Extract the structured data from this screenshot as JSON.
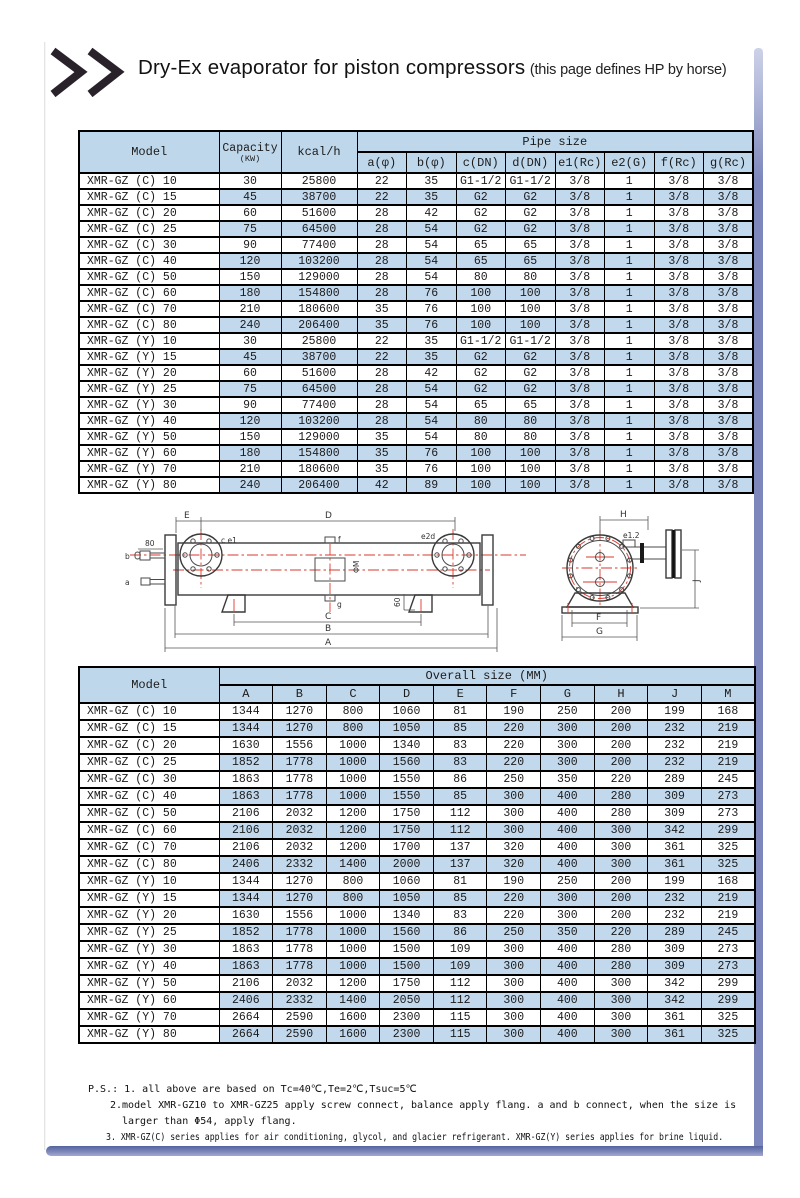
{
  "header": {
    "title": "Dry-Ex evaporator for piston compressors",
    "subtitle": "(this page defines HP by horse)",
    "chevron_icon": "double-chevron-right"
  },
  "colors": {
    "row_blue": "#c2d8ec",
    "header_blue": "#bfd7eb",
    "accent_bar": "#7d87bb",
    "drawing_red": "#d93a2e"
  },
  "pipe_table": {
    "col_model": "Model",
    "col_capacity": "Capacity",
    "col_capacity_unit": "(KW)",
    "col_kcal": "kcal/h",
    "group_header": "Pipe size",
    "sub_headers": [
      "a(φ)",
      "b(φ)",
      "c(DN)",
      "d(DN)",
      "e1(Rc)",
      "e2(G)",
      "f(Rc)",
      "g(Rc)"
    ],
    "rows": [
      [
        "XMR-GZ (C) 10",
        "30",
        "25800",
        "22",
        "35",
        "G1-1/2",
        "G1-1/2",
        "3/8",
        "1",
        "3/8",
        "3/8"
      ],
      [
        "XMR-GZ (C) 15",
        "45",
        "38700",
        "22",
        "35",
        "G2",
        "G2",
        "3/8",
        "1",
        "3/8",
        "3/8"
      ],
      [
        "XMR-GZ (C) 20",
        "60",
        "51600",
        "28",
        "42",
        "G2",
        "G2",
        "3/8",
        "1",
        "3/8",
        "3/8"
      ],
      [
        "XMR-GZ (C) 25",
        "75",
        "64500",
        "28",
        "54",
        "G2",
        "G2",
        "3/8",
        "1",
        "3/8",
        "3/8"
      ],
      [
        "XMR-GZ (C) 30",
        "90",
        "77400",
        "28",
        "54",
        "65",
        "65",
        "3/8",
        "1",
        "3/8",
        "3/8"
      ],
      [
        "XMR-GZ (C) 40",
        "120",
        "103200",
        "28",
        "54",
        "65",
        "65",
        "3/8",
        "1",
        "3/8",
        "3/8"
      ],
      [
        "XMR-GZ (C) 50",
        "150",
        "129000",
        "28",
        "54",
        "80",
        "80",
        "3/8",
        "1",
        "3/8",
        "3/8"
      ],
      [
        "XMR-GZ (C) 60",
        "180",
        "154800",
        "28",
        "76",
        "100",
        "100",
        "3/8",
        "1",
        "3/8",
        "3/8"
      ],
      [
        "XMR-GZ (C) 70",
        "210",
        "180600",
        "35",
        "76",
        "100",
        "100",
        "3/8",
        "1",
        "3/8",
        "3/8"
      ],
      [
        "XMR-GZ (C) 80",
        "240",
        "206400",
        "35",
        "76",
        "100",
        "100",
        "3/8",
        "1",
        "3/8",
        "3/8"
      ],
      [
        "XMR-GZ (Y) 10",
        "30",
        "25800",
        "22",
        "35",
        "G1-1/2",
        "G1-1/2",
        "3/8",
        "1",
        "3/8",
        "3/8"
      ],
      [
        "XMR-GZ (Y) 15",
        "45",
        "38700",
        "22",
        "35",
        "G2",
        "G2",
        "3/8",
        "1",
        "3/8",
        "3/8"
      ],
      [
        "XMR-GZ (Y) 20",
        "60",
        "51600",
        "28",
        "42",
        "G2",
        "G2",
        "3/8",
        "1",
        "3/8",
        "3/8"
      ],
      [
        "XMR-GZ (Y) 25",
        "75",
        "64500",
        "28",
        "54",
        "G2",
        "G2",
        "3/8",
        "1",
        "3/8",
        "3/8"
      ],
      [
        "XMR-GZ (Y) 30",
        "90",
        "77400",
        "28",
        "54",
        "65",
        "65",
        "3/8",
        "1",
        "3/8",
        "3/8"
      ],
      [
        "XMR-GZ (Y) 40",
        "120",
        "103200",
        "28",
        "54",
        "80",
        "80",
        "3/8",
        "1",
        "3/8",
        "3/8"
      ],
      [
        "XMR-GZ (Y) 50",
        "150",
        "129000",
        "35",
        "54",
        "80",
        "80",
        "3/8",
        "1",
        "3/8",
        "3/8"
      ],
      [
        "XMR-GZ (Y) 60",
        "180",
        "154800",
        "35",
        "76",
        "100",
        "100",
        "3/8",
        "1",
        "3/8",
        "3/8"
      ],
      [
        "XMR-GZ (Y) 70",
        "210",
        "180600",
        "35",
        "76",
        "100",
        "100",
        "3/8",
        "1",
        "3/8",
        "3/8"
      ],
      [
        "XMR-GZ (Y) 80",
        "240",
        "206400",
        "42",
        "89",
        "100",
        "100",
        "3/8",
        "1",
        "3/8",
        "3/8"
      ]
    ]
  },
  "size_table": {
    "col_model": "Model",
    "group_header": "Overall size (MM)",
    "sub_headers": [
      "A",
      "B",
      "C",
      "D",
      "E",
      "F",
      "G",
      "H",
      "J",
      "M"
    ],
    "rows": [
      [
        "XMR-GZ (C) 10",
        "1344",
        "1270",
        "800",
        "1060",
        "81",
        "190",
        "250",
        "200",
        "199",
        "168"
      ],
      [
        "XMR-GZ (C) 15",
        "1344",
        "1270",
        "800",
        "1050",
        "85",
        "220",
        "300",
        "200",
        "232",
        "219"
      ],
      [
        "XMR-GZ (C) 20",
        "1630",
        "1556",
        "1000",
        "1340",
        "83",
        "220",
        "300",
        "200",
        "232",
        "219"
      ],
      [
        "XMR-GZ (C) 25",
        "1852",
        "1778",
        "1000",
        "1560",
        "83",
        "220",
        "300",
        "200",
        "232",
        "219"
      ],
      [
        "XMR-GZ (C) 30",
        "1863",
        "1778",
        "1000",
        "1550",
        "86",
        "250",
        "350",
        "220",
        "289",
        "245"
      ],
      [
        "XMR-GZ (C) 40",
        "1863",
        "1778",
        "1000",
        "1550",
        "85",
        "300",
        "400",
        "280",
        "309",
        "273"
      ],
      [
        "XMR-GZ (C) 50",
        "2106",
        "2032",
        "1200",
        "1750",
        "112",
        "300",
        "400",
        "280",
        "309",
        "273"
      ],
      [
        "XMR-GZ (C) 60",
        "2106",
        "2032",
        "1200",
        "1750",
        "112",
        "300",
        "400",
        "300",
        "342",
        "299"
      ],
      [
        "XMR-GZ (C) 70",
        "2106",
        "2032",
        "1200",
        "1700",
        "137",
        "320",
        "400",
        "300",
        "361",
        "325"
      ],
      [
        "XMR-GZ (C) 80",
        "2406",
        "2332",
        "1400",
        "2000",
        "137",
        "320",
        "400",
        "300",
        "361",
        "325"
      ],
      [
        "XMR-GZ (Y) 10",
        "1344",
        "1270",
        "800",
        "1060",
        "81",
        "190",
        "250",
        "200",
        "199",
        "168"
      ],
      [
        "XMR-GZ (Y) 15",
        "1344",
        "1270",
        "800",
        "1050",
        "85",
        "220",
        "300",
        "200",
        "232",
        "219"
      ],
      [
        "XMR-GZ (Y) 20",
        "1630",
        "1556",
        "1000",
        "1340",
        "83",
        "220",
        "300",
        "200",
        "232",
        "219"
      ],
      [
        "XMR-GZ (Y) 25",
        "1852",
        "1778",
        "1000",
        "1560",
        "86",
        "250",
        "350",
        "220",
        "289",
        "245"
      ],
      [
        "XMR-GZ (Y) 30",
        "1863",
        "1778",
        "1000",
        "1500",
        "109",
        "300",
        "400",
        "280",
        "309",
        "273"
      ],
      [
        "XMR-GZ (Y) 40",
        "1863",
        "1778",
        "1000",
        "1500",
        "109",
        "300",
        "400",
        "280",
        "309",
        "273"
      ],
      [
        "XMR-GZ (Y) 50",
        "2106",
        "2032",
        "1200",
        "1750",
        "112",
        "300",
        "400",
        "300",
        "342",
        "299"
      ],
      [
        "XMR-GZ (Y) 60",
        "2406",
        "2332",
        "1400",
        "2050",
        "112",
        "300",
        "400",
        "300",
        "342",
        "299"
      ],
      [
        "XMR-GZ (Y) 70",
        "2664",
        "2590",
        "1600",
        "2300",
        "115",
        "300",
        "400",
        "300",
        "361",
        "325"
      ],
      [
        "XMR-GZ (Y) 80",
        "2664",
        "2590",
        "1600",
        "2300",
        "115",
        "300",
        "400",
        "300",
        "361",
        "325"
      ]
    ]
  },
  "diagram": {
    "labels": {
      "E": "E",
      "D": "D",
      "A": "A",
      "B": "B",
      "C": "C",
      "f": "f",
      "g": "g",
      "a": "a",
      "b": "b",
      "ce1": "c e1",
      "e2d": "e2d",
      "dim80": "80",
      "dim60": "60",
      "phiM": "ΦM",
      "H": "H",
      "e12": "e1.2",
      "J": "J",
      "F": "F",
      "G": "G"
    }
  },
  "notes": {
    "line1": "P.S.: 1. all above are based on Tc=40℃,Te=2℃,Tsuc=5℃",
    "line2": "2.model XMR-GZ10 to XMR-GZ25 apply screw connect, balance apply flang. a and b connect, when the size is",
    "line3": "larger than Φ54, apply flang.",
    "line4": "3. XMR-GZ(C) series applies for air conditioning, glycol, and glacier refrigerant. XMR-GZ(Y) series applies for brine liquid."
  }
}
